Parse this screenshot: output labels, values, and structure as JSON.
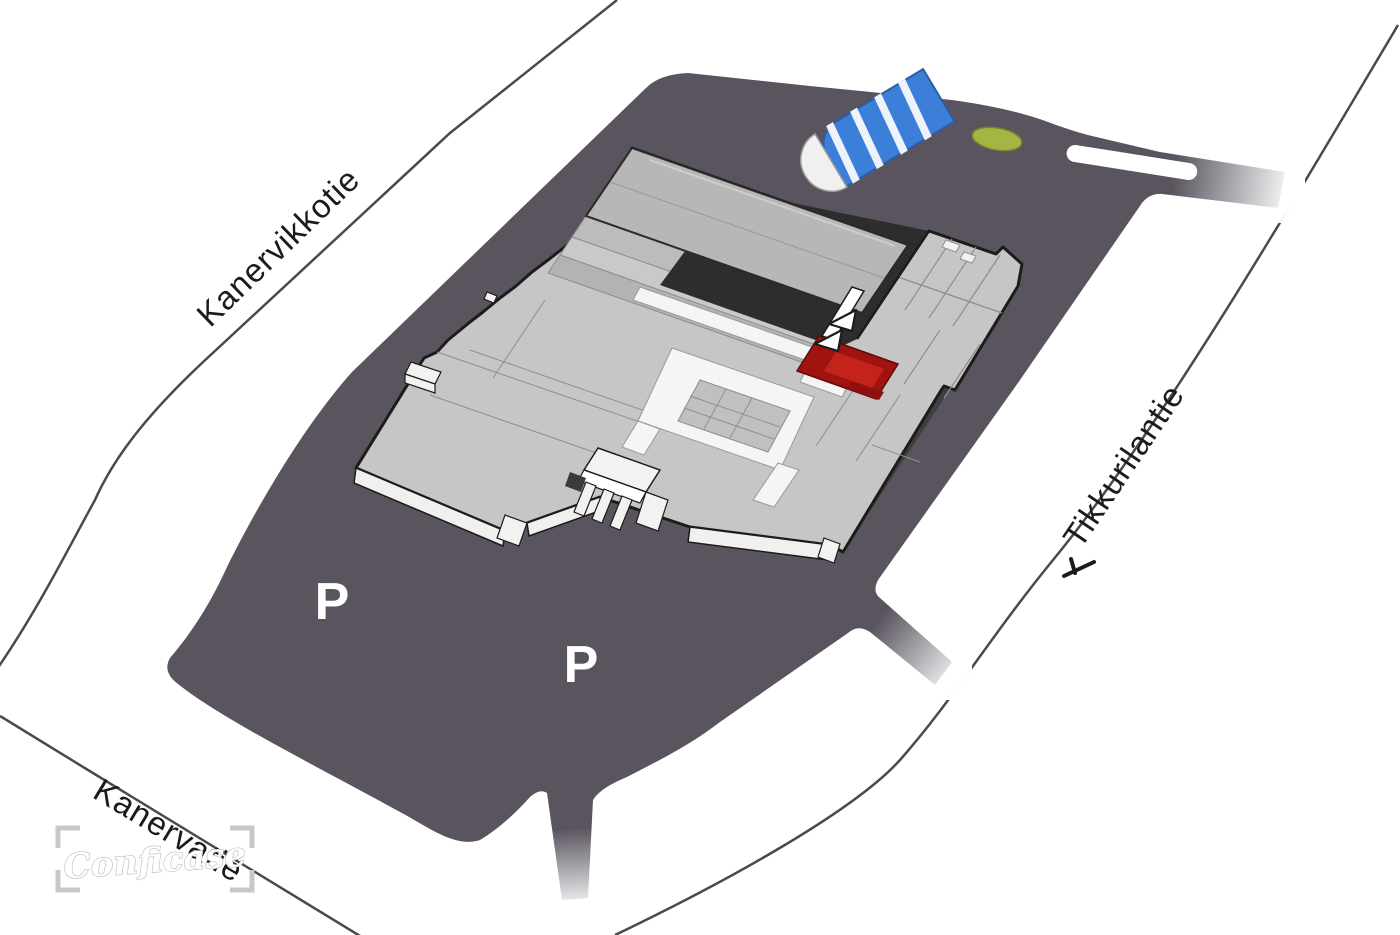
{
  "map": {
    "streets": {
      "northwest": "Kanervikkotie",
      "east": "Tikkurilantie",
      "southwest": "Kanervatie"
    },
    "parking": {
      "label_left": "P",
      "label_right": "P"
    },
    "watermark": {
      "text": "Conficase"
    },
    "colors": {
      "background": "#ffffff",
      "site": "#59545e",
      "road_line": "#4a4a4a",
      "building_roof": "#c6c6c6",
      "building_outline": "#1c1c1c",
      "upper_block": "#b7b7b7",
      "shadow_gap": "#2d2d2d",
      "corridor": "#f5f5f3",
      "highlight_unit": "#a01410",
      "highlight_unit_light": "#c4231a",
      "tunnel_blue": "#3c7fd8",
      "lawn_green": "#a5b544",
      "parking_letter": "#ffffff",
      "label_text": "#1b1b1b"
    }
  }
}
